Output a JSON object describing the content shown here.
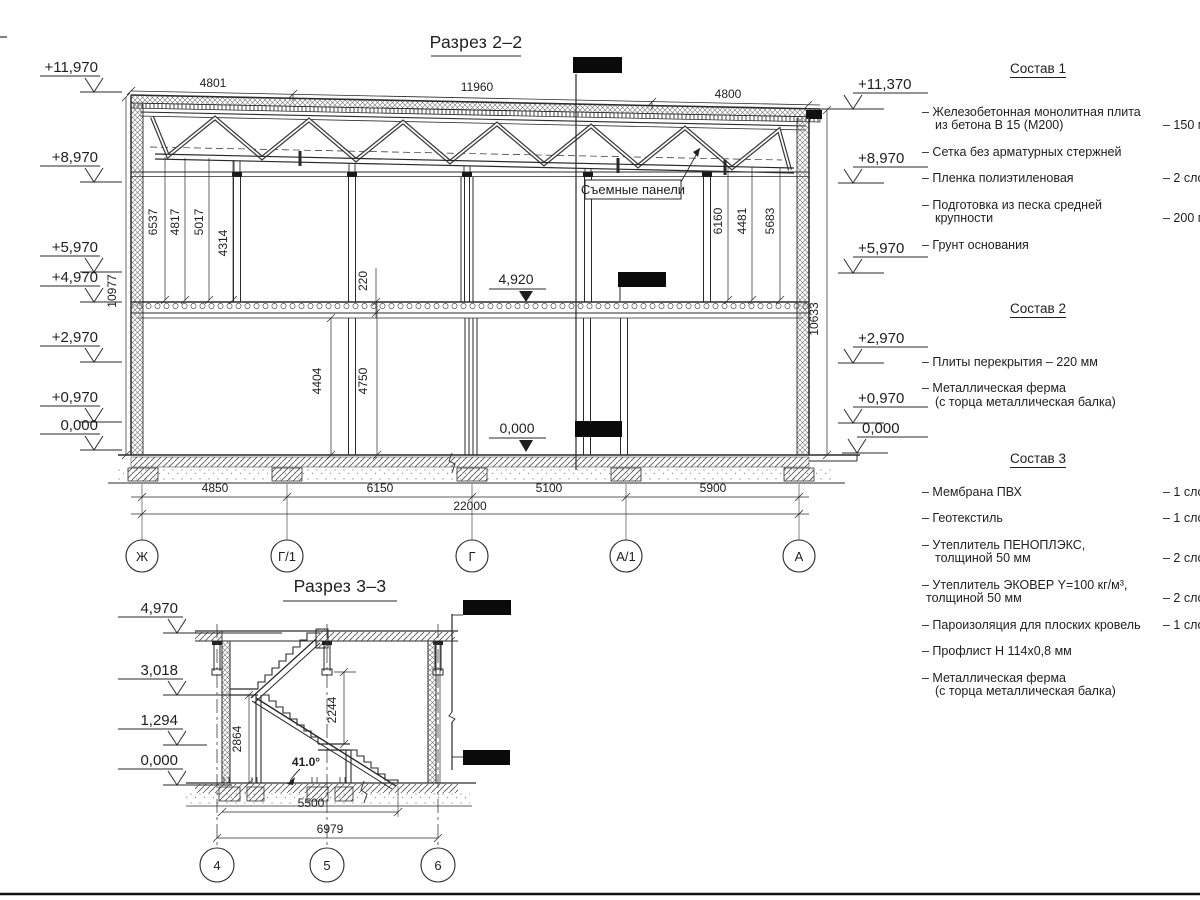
{
  "section22": {
    "title": "Разрез 2–2",
    "panels_label": "Съемные панели",
    "levels_left": [
      "+11,970",
      "+8,970",
      "+5,970",
      "+4,970",
      "+2,970",
      "+0,970",
      "0,000"
    ],
    "levels_right": [
      "+11,370",
      "+8,970",
      "+5,970",
      "+2,970",
      "+0,970",
      "0,000"
    ],
    "level_slab": "4,920",
    "level_ground": "0,000",
    "dims_top": [
      "4801",
      "11960",
      "4800"
    ],
    "dims_chord_left": [
      "6537",
      "4817",
      "5017",
      "4314"
    ],
    "dims_chord_right": [
      "6160",
      "4481",
      "5683"
    ],
    "dim_slab_thickness": "220",
    "dims_floor": [
      "4404",
      "4750"
    ],
    "dim_height_left": "10977",
    "dim_height_right": "10633",
    "dims_span": [
      "4850",
      "6150",
      "5100",
      "5900"
    ],
    "dim_total": "22000",
    "axes": [
      "Ж",
      "Г/1",
      "Г",
      "А/1",
      "А"
    ]
  },
  "section33": {
    "title": "Разрез 3–3",
    "levels": [
      "4,970",
      "3,018",
      "1,294",
      "0,000"
    ],
    "dim_landing": "2864",
    "dim_flight": "2244",
    "angle": "41.0°",
    "dims_bottom": [
      "5500",
      "6979"
    ],
    "axes": [
      "4",
      "5",
      "6"
    ]
  },
  "compositions": [
    {
      "title": "Состав 1",
      "items": [
        {
          "l1": "– Железобетонная  монолитная плита",
          "l2": "из бетона В 15 (М200)",
          "value": "– 150 мм"
        },
        {
          "l1": "– Сетка без арматурных стержней"
        },
        {
          "l1": "– Пленка полиэтиленовая",
          "value": "–  2 слоя"
        },
        {
          "l1": "– Подготовка из песка средней",
          "l2": "крупности",
          "value": "– 200 мм"
        },
        {
          "l1": "– Грунт основания"
        }
      ]
    },
    {
      "title": "Состав 2",
      "items": [
        {
          "l1": "– Плиты перекрытия – 220 мм"
        },
        {
          "l1": "– Металлическая ферма",
          "l2": "(с торца металлическая балка)"
        }
      ]
    },
    {
      "title": "Состав 3",
      "items": [
        {
          "l1": "– Мембрана ПВХ",
          "value": "– 1 слой"
        },
        {
          "l1": "– Геотекстиль",
          "value": "– 1 слой"
        },
        {
          "l1": "– Утеплитель ПЕНОПЛЭКС,",
          "l2": "толщиной 50 мм",
          "value": "– 2 слоя"
        },
        {
          "l1": "– Утеплитель ЭКОВЕР Y=100 кг/м³,",
          "l2": "толщиной 50 мм",
          "value": "– 2 слоя"
        },
        {
          "l1": "– Пароизоляция для плоских кровель",
          "value": "– 1 слой"
        },
        {
          "l1": "– Профлист Н 114х0,8 мм"
        },
        {
          "l1": "– Металлическая ферма",
          "l2": "(с торца металлическая балка)"
        }
      ]
    }
  ]
}
